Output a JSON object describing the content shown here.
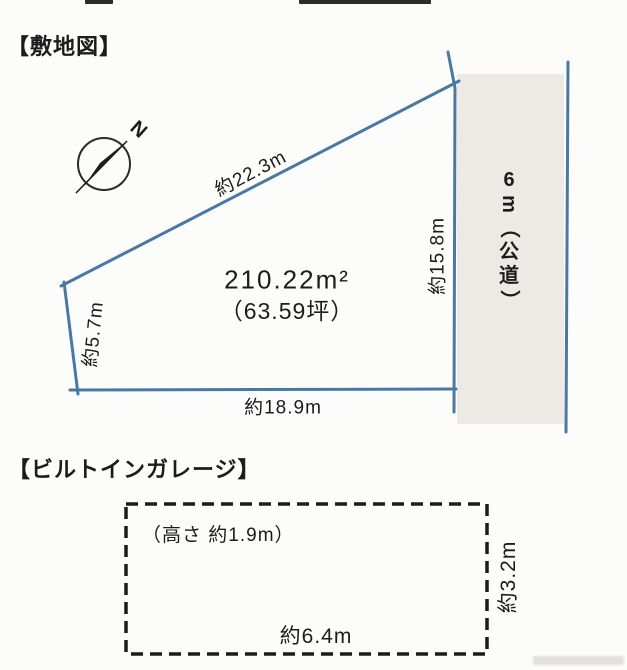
{
  "site_plan": {
    "title": "【敷地図】",
    "compass": {
      "label": "N"
    },
    "area": {
      "square_meters": "210.22m²",
      "tsubo": "（63.59坪）"
    },
    "dimensions": {
      "top_edge": "約22.3m",
      "right_edge": "約15.8m",
      "left_edge": "約5.7m",
      "bottom_edge": "約18.9m"
    },
    "road": {
      "label": "6m（公道）",
      "label_chars": [
        "6",
        "m",
        "（",
        "公",
        "道",
        "）"
      ]
    }
  },
  "garage": {
    "title": "【ビルトインガレージ】",
    "height_note": "（高さ 約1.9m）",
    "width_label": "約6.4m",
    "depth_label": "約3.2m"
  },
  "colors": {
    "plot_line": "#4a78a4",
    "road_fill": "#edeae6",
    "ink": "#1c1c1c"
  }
}
